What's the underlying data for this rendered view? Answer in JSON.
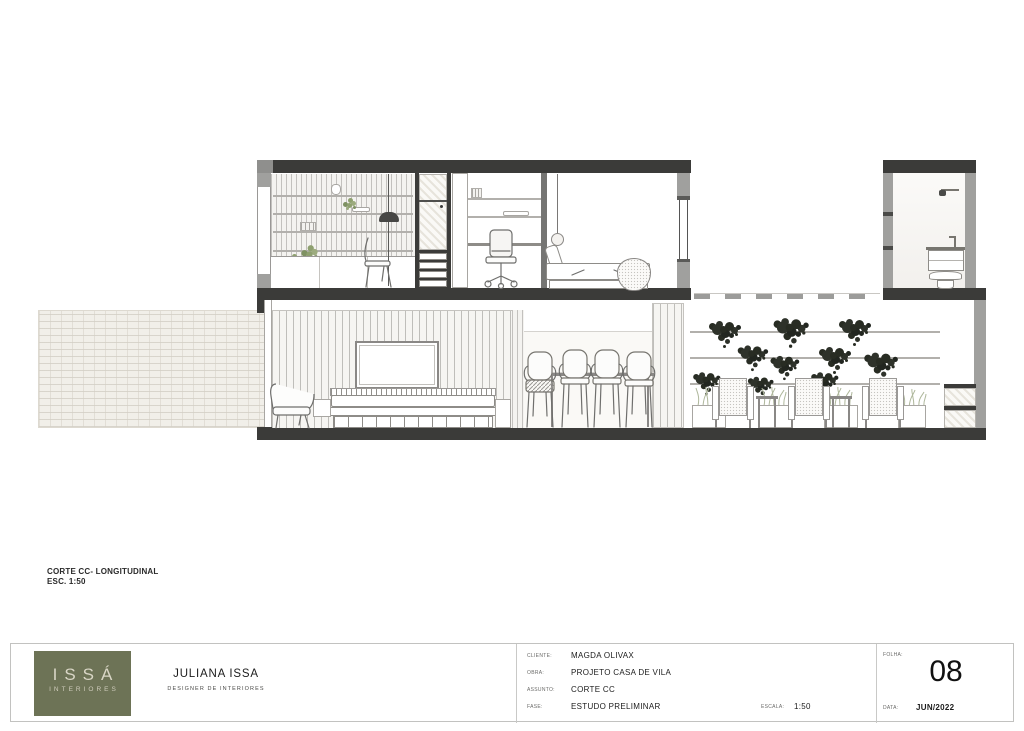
{
  "sheet": {
    "drawing_label": {
      "title": "CORTE CC- LONGITUDINAL",
      "scale": "ESC. 1:50"
    }
  },
  "title_block": {
    "logo": {
      "name": "ISSÁ",
      "subtitle": "INTERIORES"
    },
    "author": {
      "name": "JULIANA ISSA",
      "role": "DESIGNER DE INTERIORES"
    },
    "fields": [
      {
        "label": "CLIENTE:",
        "value": "MAGDA OLIVAX"
      },
      {
        "label": "OBRA:",
        "value": "PROJETO CASA DE VILA"
      },
      {
        "label": "ASSUNTO:",
        "value": "CORTE CC"
      },
      {
        "label": "FASE:",
        "value": "ESTUDO PRELIMINAR"
      }
    ],
    "scale": {
      "label": "ESCALA:",
      "value": "1:50"
    },
    "sheet_number": {
      "label": "FOLHA:",
      "value": "08"
    },
    "date": {
      "label": "DATA:",
      "value": "JUN/2022"
    }
  },
  "colors": {
    "logo_background": "#6d7356",
    "slab_dark": "#3b3b39",
    "wall_gray": "#a0a09e",
    "plant_dark": "#282c23",
    "plant_green": "#8ea06f"
  }
}
